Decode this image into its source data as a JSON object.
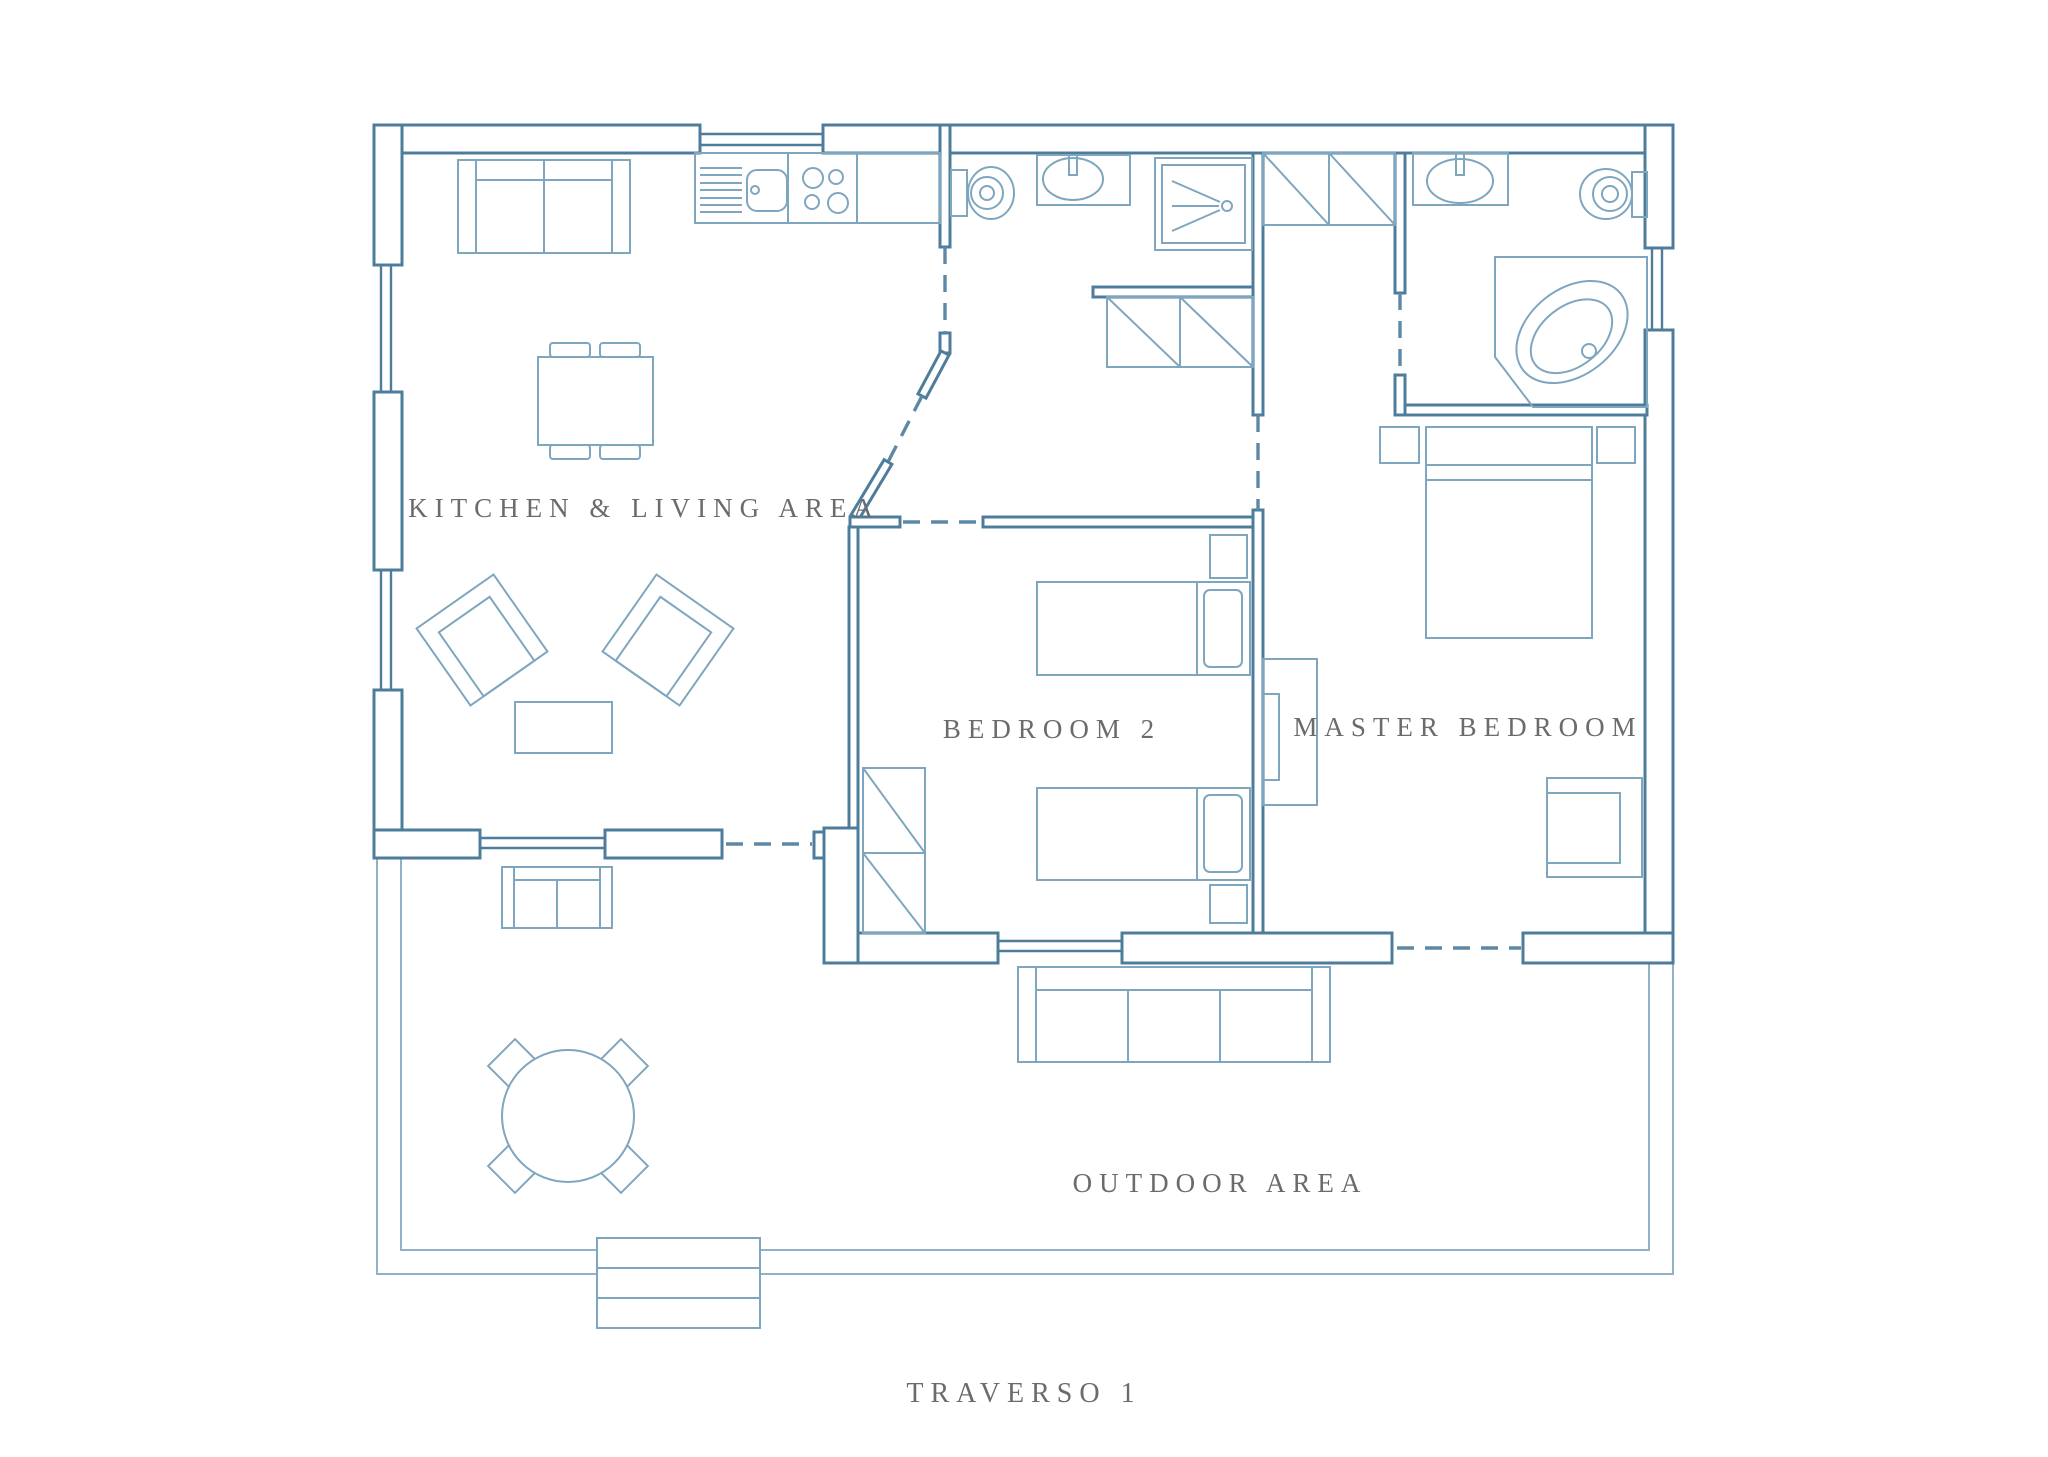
{
  "plan": {
    "title": "TRAVERSO 1",
    "rooms": {
      "kitchen_living": {
        "label": "KITCHEN & LIVING AREA"
      },
      "bedroom2": {
        "label": "BEDROOM 2"
      },
      "master_bedroom": {
        "label": "MASTER BEDROOM"
      },
      "outdoor": {
        "label": "OUTDOOR AREA"
      }
    },
    "colors": {
      "wall": "#4e7d9b",
      "furniture": "#7fa6bf",
      "deck": "#8fb2c6",
      "door_dash": "#5d89a7",
      "label_text": "#6b6b6b",
      "background": "#ffffff"
    },
    "icons": [
      "sofa-icon",
      "kitchen-counter-icon",
      "kitchen-sink-icon",
      "stove-icon",
      "dining-table-icon",
      "armchair-icon",
      "coffee-table-icon",
      "outdoor-sofa-icon",
      "round-table-icon",
      "steps-icon",
      "single-bed-icon",
      "double-bed-icon",
      "nightstand-icon",
      "wardrobe-icon",
      "toilet-icon",
      "bathroom-sink-icon",
      "shower-icon",
      "corner-bathtub-icon",
      "media-unit-icon",
      "desk-icon"
    ]
  }
}
